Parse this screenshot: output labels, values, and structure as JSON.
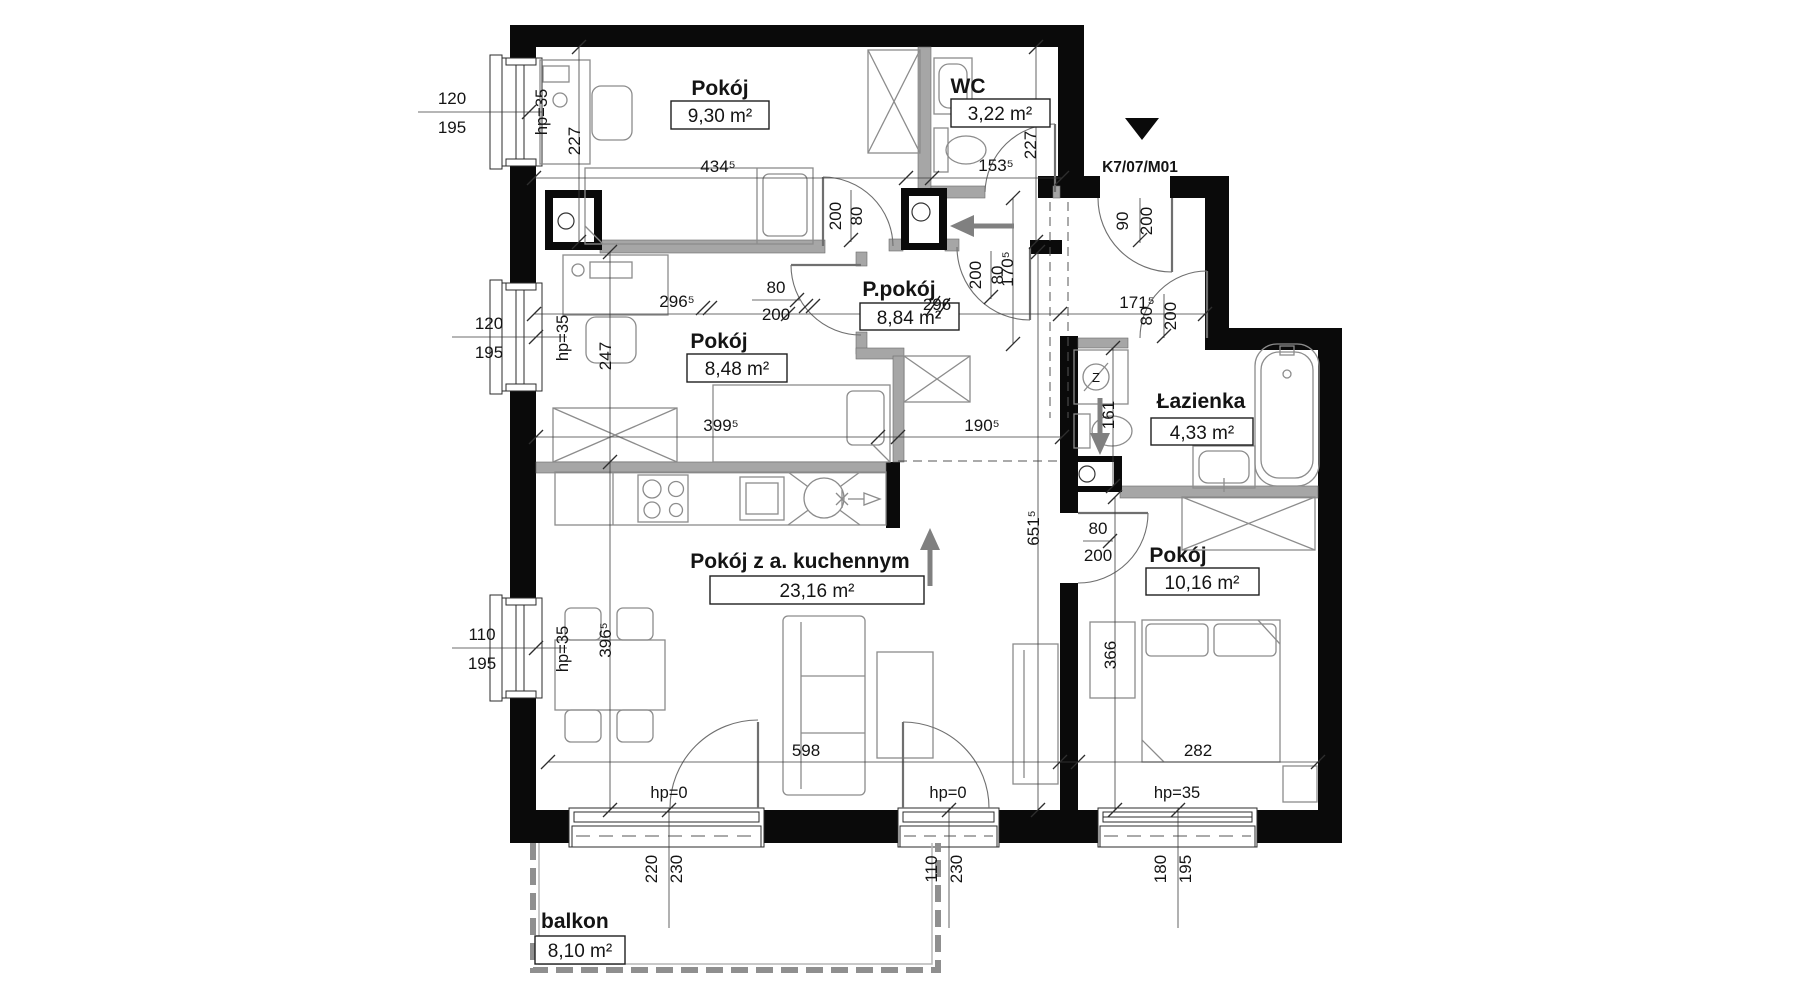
{
  "plan": {
    "unit_code": "K7/07/M01",
    "rooms": [
      {
        "name": "Pokój",
        "area": "9,30 m²"
      },
      {
        "name": "WC",
        "area": "3,22 m²"
      },
      {
        "name": "Pokój",
        "area": "8,48 m²"
      },
      {
        "name": "P.pokój",
        "area": "8,84 m²"
      },
      {
        "name": "Łazienka",
        "area": "4,33 m²"
      },
      {
        "name": "Pokój z a. kuchennym",
        "area": "23,16 m²"
      },
      {
        "name": "Pokój",
        "area": "10,16 m²"
      },
      {
        "name": "balkon",
        "area": "8,10 m²"
      }
    ],
    "dims": {
      "room1_width": "434⁵",
      "room1_height": "227",
      "wc_width": "153⁵",
      "wc_height": "227",
      "room2_width": "296⁵",
      "room2_desk": "247",
      "room2_bottom": "399⁵",
      "hall_width_crossed": "296",
      "hall_entry_width": "171⁵",
      "hall_entry_height": "170⁵",
      "kitchen_opening": "190⁵",
      "living_width": "598",
      "living_height": "651⁵",
      "dining_height": "396⁵",
      "bath_niche": "161",
      "bedroom_width": "282",
      "bedroom_height": "366"
    },
    "windows": {
      "left1": {
        "w": "120",
        "h": "195",
        "hp": "hp=35"
      },
      "left2": {
        "w": "120",
        "h": "195",
        "hp": "hp=35"
      },
      "left3": {
        "w": "110",
        "h": "195",
        "hp": "hp=35"
      },
      "bottom1": {
        "w": "220",
        "h": "230",
        "hp": "hp=0"
      },
      "bottom2": {
        "w": "110",
        "h": "230",
        "hp": "hp=0"
      },
      "bottom3": {
        "w": "180",
        "h": "195",
        "hp": "hp=35"
      }
    },
    "doors": {
      "room1": {
        "w": "80",
        "h": "200"
      },
      "room2": {
        "w": "80",
        "h": "200"
      },
      "hall": {
        "w": "80",
        "h": "200"
      },
      "entrance": {
        "w": "90",
        "h": "200"
      },
      "bathroom": {
        "w": "80",
        "h": "200"
      },
      "bedroom": {
        "w": "80",
        "h": "200"
      }
    },
    "symbols": {
      "boiler": "Z"
    }
  }
}
